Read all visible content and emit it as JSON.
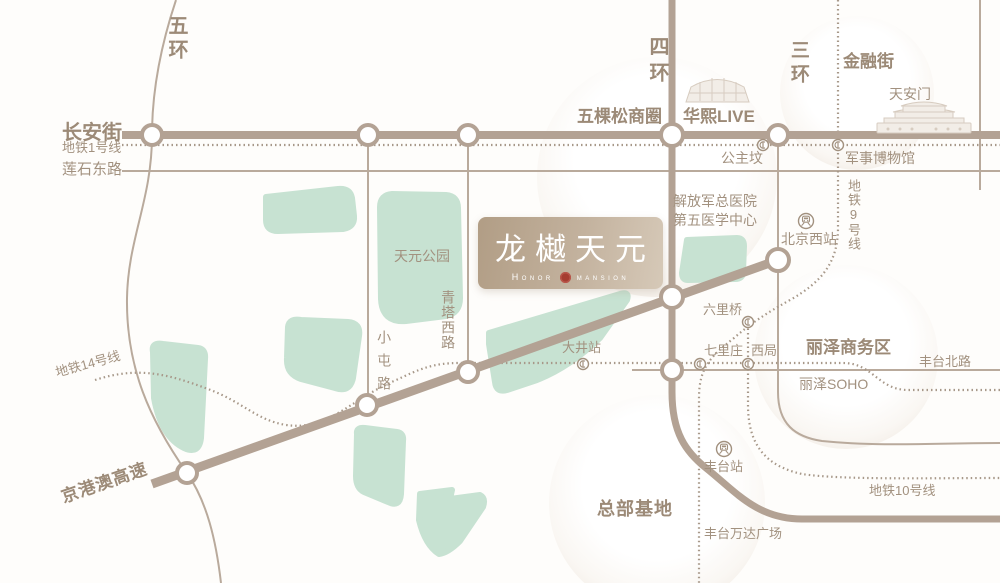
{
  "map": {
    "colors": {
      "background": "#fefdfb",
      "road": "#b3a294",
      "metro_dash": "#a79889",
      "label_text": "#a2917f",
      "park_green": "#c7e2d2",
      "logo_gradient_start": "#b19d85",
      "logo_gradient_end": "#d6c9b8",
      "seal_red": "#a63d31"
    },
    "logo": {
      "title": "龙樾天元",
      "subtitle_left": "Honor",
      "subtitle_right": "mansion"
    },
    "labels": {
      "ring5": "五环",
      "changanjie": "长安街",
      "metro_line1": "地铁1号线",
      "lianshidonglu": "莲石东路",
      "ring4": "四环",
      "wukesong": "五棵松商圈",
      "huaxi_live": "华熙LIVE",
      "ring3": "三环",
      "jinrongjie": "金融街",
      "tiananmen": "天安门",
      "gongzhufen": "公主坟",
      "junshibowuguan": "军事博物馆",
      "metro_line9": "地铁9号线",
      "hospital_line1": "解放军总医院",
      "hospital_line2": "第五医学中心",
      "beijing_west_station": "北京西站",
      "tianyuan_park": "天元公园",
      "qingtaxilu": "青塔西路",
      "xiaotunlu": "小屯路",
      "dajing_station": "大井站",
      "metro_line14": "地铁14号线",
      "liuliqiao": "六里桥",
      "qilizhuang": "七里庄",
      "xiju": "西局",
      "lize_business": "丽泽商务区",
      "fengtaibeilu": "丰台北路",
      "lize_soho": "丽泽SOHO",
      "jinggangao_expwy": "京港澳高速",
      "zongbu_jidi": "总部基地",
      "fengtai_station": "丰台站",
      "fengtai_wanda": "丰台万达广场",
      "metro_line10": "地铁10号线"
    },
    "icons": {
      "metro": "metro-station-icon",
      "railway": "railway-station-icon",
      "stadium": "stadium-icon",
      "gate": "tiananmen-gate-icon"
    }
  }
}
